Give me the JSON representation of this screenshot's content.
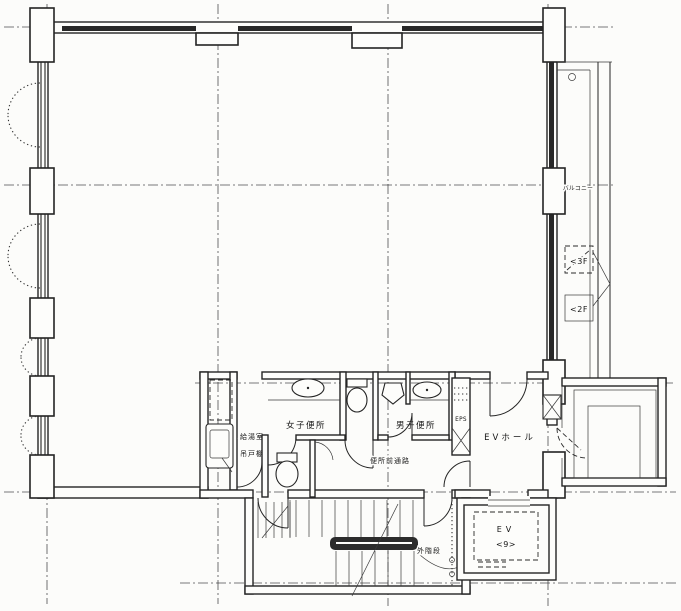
{
  "plan": {
    "rooms": {
      "womens_toilet": "女子便所",
      "mens_toilet": "男子便所",
      "toilet_corridor": "便所前通路",
      "kitchenette": "給湯室",
      "hanging_cupboard": "吊戸棚",
      "ev_hall": "EVホール",
      "eps": "EPS",
      "outside_stair": "外階段",
      "balcony": "バルコニー"
    },
    "elevator": {
      "label": "EV",
      "capacity": "<9>"
    },
    "stair_markers": {
      "to_3f": "<3F",
      "to_2f": "<2F"
    },
    "colors": {
      "ink": "#242424",
      "paper": "#fcfcfa"
    }
  }
}
